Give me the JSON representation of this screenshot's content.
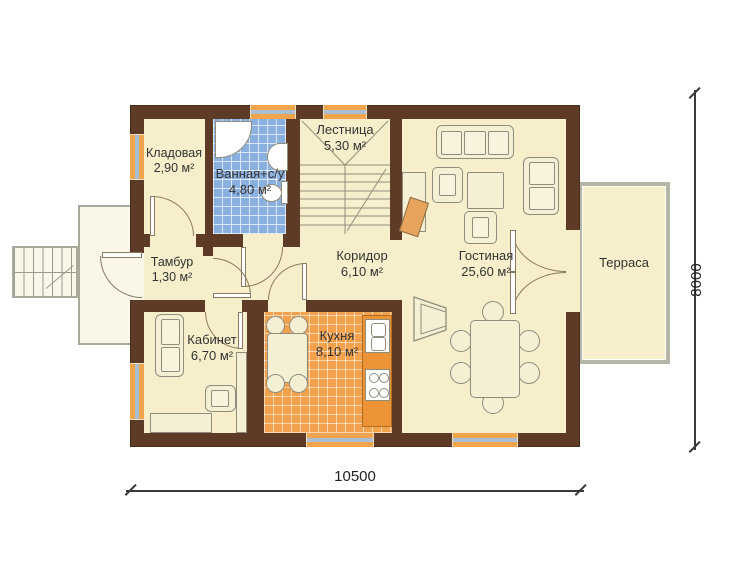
{
  "plan": {
    "type": "floor-plan",
    "language": "ru"
  },
  "rooms": [
    {
      "name": "Кладовая",
      "area": "2,90 м²"
    },
    {
      "name": "Ванная+с/у",
      "area": "4,80 м²"
    },
    {
      "name": "Лестница",
      "area": "5,30 м²"
    },
    {
      "name": "Тамбур",
      "area": "1,30 м²"
    },
    {
      "name": "Коридор",
      "area": "6,10 м²"
    },
    {
      "name": "Кабинет",
      "area": "6,70 м²"
    },
    {
      "name": "Кухня",
      "area": "8,10 м²"
    },
    {
      "name": "Гостиная",
      "area": "25,60 м²"
    },
    {
      "name": "Терраса",
      "area": ""
    }
  ],
  "dimensions": {
    "width_label": "10500",
    "height_label": "8000"
  },
  "colors": {
    "wall": "#5D3B27",
    "floor": "#F7EFCB",
    "kitchen_tile": "#F2A14D",
    "bathroom_tile": "#8AB0E0",
    "window_frame": "#F0A44C",
    "window_glass": "#A9BFD2",
    "terrace_outline": "#B5B5A8"
  }
}
